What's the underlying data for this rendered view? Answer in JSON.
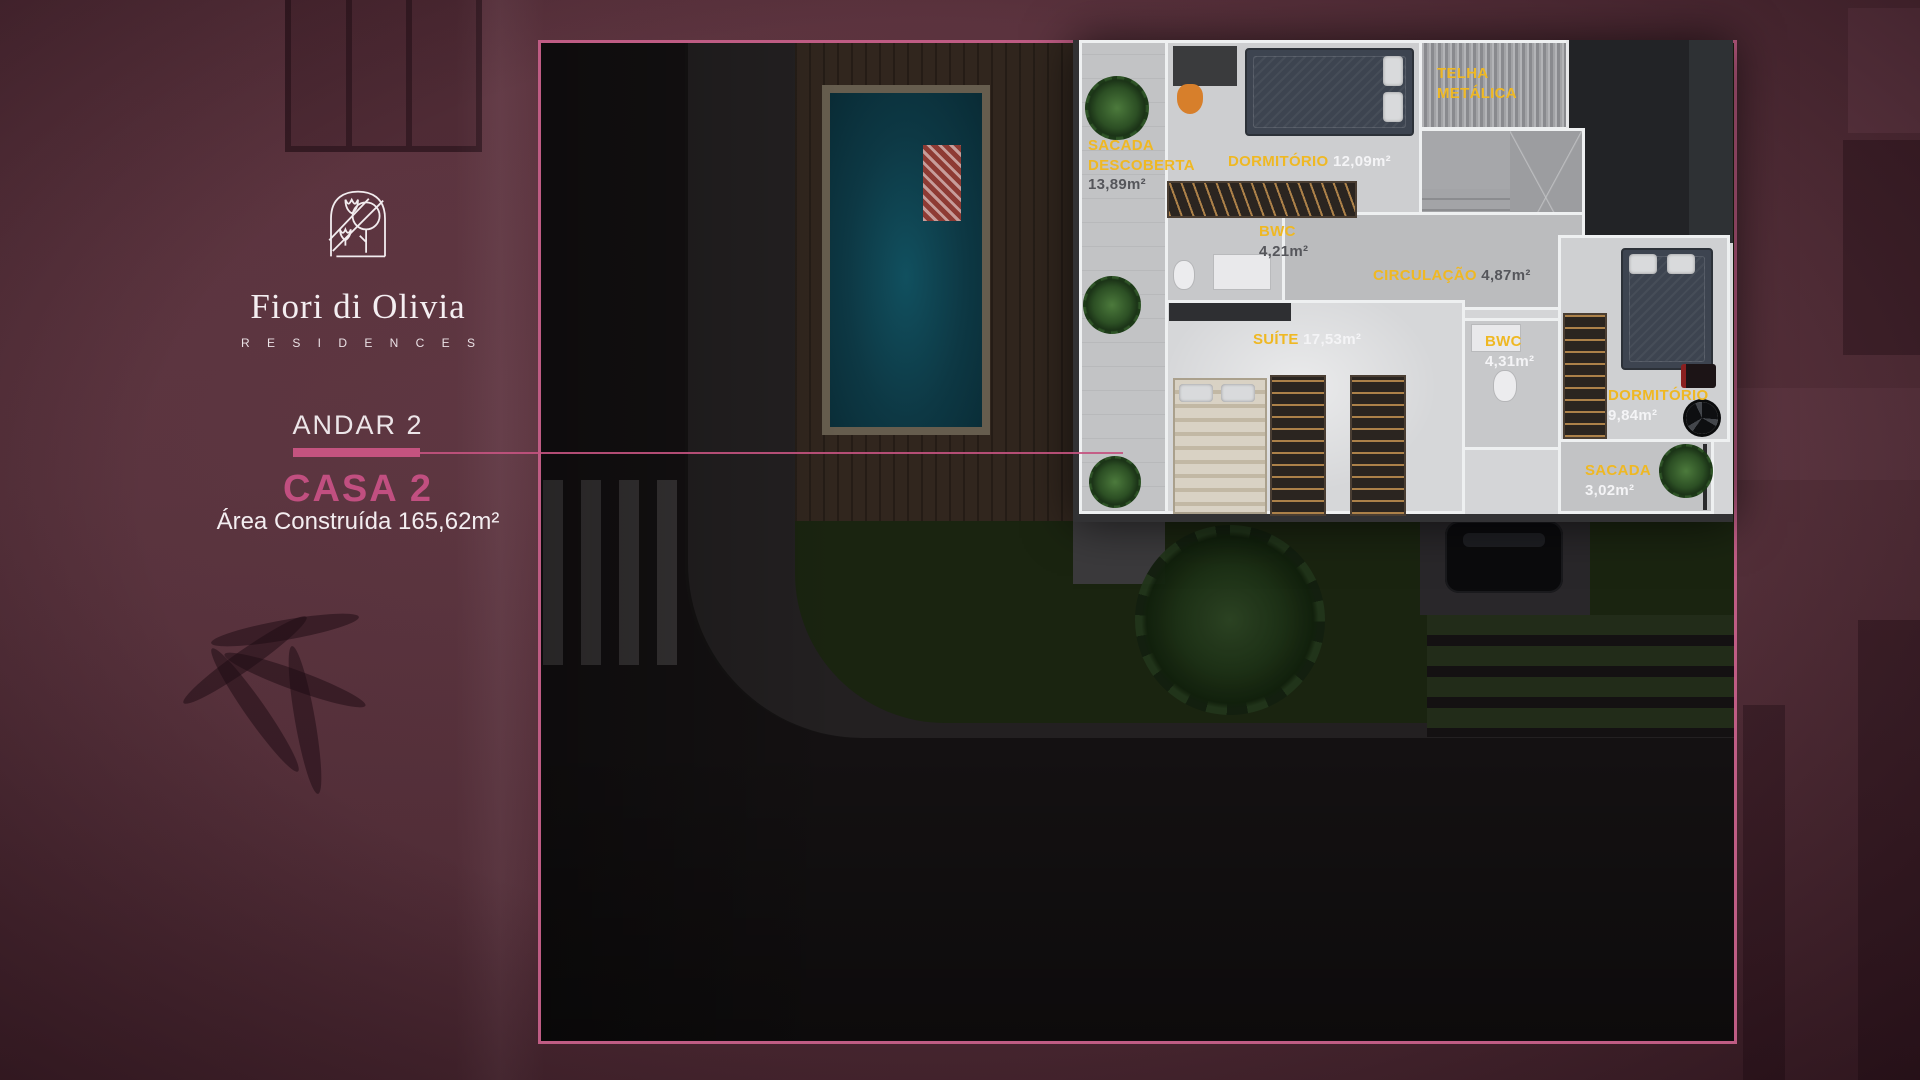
{
  "brand": {
    "name": "Fiori di Olivia",
    "subtitle": "R E S I D E N C E S"
  },
  "info": {
    "floor_label": "ANDAR 2",
    "unit_label": "CASA 2",
    "area_label": "Área Construída 165,62m²"
  },
  "icons": {
    "brand_logo": "olive-tree-arch-logo"
  },
  "colors": {
    "background_maroon": "#56313b",
    "accent_pink": "#c4537f",
    "frame_border_pink": "#bf5c84",
    "unit_label_pink": "#c14f80",
    "room_label_yellow": "#efb823",
    "room_value_light": "#f4f4f6",
    "room_value_dark": "#55565b",
    "pool_water": "#0d3844"
  },
  "floor_plan": {
    "rooms": [
      {
        "id": "sacada-descoberta",
        "name": "SACADA",
        "name2": "DESCOBERTA",
        "area": "13,89m²",
        "value_tone": "dark"
      },
      {
        "id": "dormitorio-1",
        "name": "DORMITÓRIO",
        "area": "12,09m²",
        "value_tone": "light"
      },
      {
        "id": "telha-metalica",
        "name": "TELHA",
        "name2": "METÁLICA",
        "area": "",
        "value_tone": "none"
      },
      {
        "id": "bwc-1",
        "name": "BWC",
        "area": "4,21m²",
        "value_tone": "dark"
      },
      {
        "id": "circulacao",
        "name": "CIRCULAÇÃO",
        "area": "4,87m²",
        "value_tone": "dark"
      },
      {
        "id": "suite",
        "name": "SUÍTE",
        "area": "17,53m²",
        "value_tone": "light"
      },
      {
        "id": "bwc-2",
        "name": "BWC",
        "area": "4,31m²",
        "value_tone": "light"
      },
      {
        "id": "dormitorio-2",
        "name": "DORMITÓRIO",
        "area": "9,84m²",
        "value_tone": "light"
      },
      {
        "id": "sacada",
        "name": "SACADA",
        "area": "3,02m²",
        "value_tone": "light"
      }
    ]
  }
}
